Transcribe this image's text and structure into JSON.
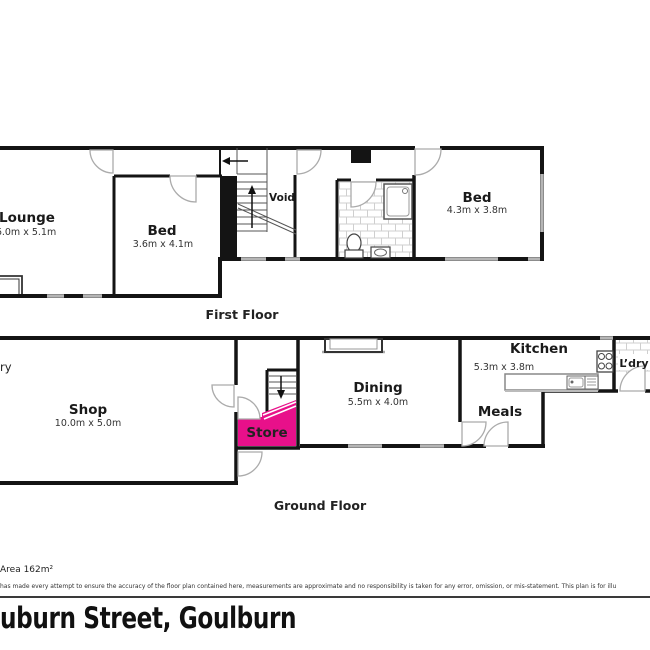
{
  "floors": {
    "first": {
      "label": "First Floor",
      "rooms": {
        "lounge": {
          "name": "Lounge",
          "dims": "6.0m x 5.1m"
        },
        "bed1": {
          "name": "Bed",
          "dims": "3.6m x 4.1m"
        },
        "void": {
          "name": "Void"
        },
        "bed2": {
          "name": "Bed",
          "dims": "4.3m x 3.8m"
        }
      }
    },
    "ground": {
      "label": "Ground Floor",
      "rooms": {
        "entry_partial": {
          "name": "ry"
        },
        "shop": {
          "name": "Shop",
          "dims": "10.0m x 5.0m"
        },
        "store": {
          "name": "Store"
        },
        "dining": {
          "name": "Dining",
          "dims": "5.5m x 4.0m"
        },
        "meals": {
          "name": "Meals"
        },
        "kitchen": {
          "name": "Kitchen",
          "dims": "5.3m x 3.8m"
        },
        "laundry": {
          "name": "L’dry"
        }
      }
    }
  },
  "footer": {
    "area_label": "Area 162m²",
    "disclaimer": "has made every attempt to ensure the accuracy of the floor plan contained here, measurements are approximate and no responsibility is taken for any error, omission, or mis-statement. This plan is for illu",
    "address": "uburn Street, Goulburn"
  },
  "colors": {
    "wall": "#141414",
    "store_fill": "#E8108A",
    "window": "#b5b5b5"
  }
}
